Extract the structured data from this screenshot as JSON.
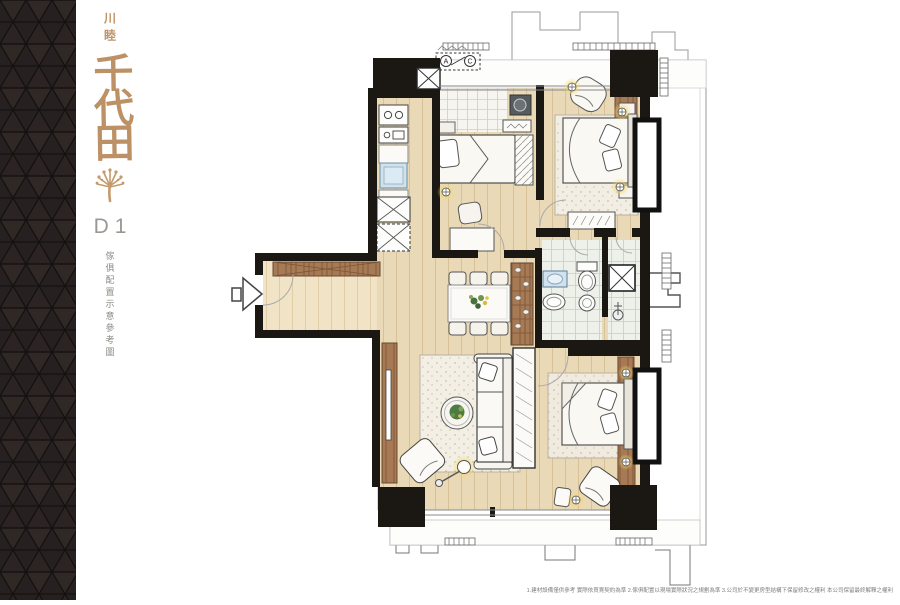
{
  "brand": {
    "developer_logo": "川睦",
    "project_name": "千代田",
    "unit_label": "D1",
    "caption": "傢俱配置示意參考圖",
    "accent_color": "#bf9467",
    "label_color": "#9b9894",
    "tree_icon": "gold-tree-logo"
  },
  "floor_plan": {
    "ac_units": [
      "A",
      "C"
    ],
    "wall_color": "#1b1713",
    "wood_floor_color": "#ead9b6",
    "entry_floor_color": "#f0e2c4",
    "furniture_wood_color": "#a67a54",
    "tile_color": "#f7f5ef",
    "bath_tile_color": "#eef0ea",
    "light_glow_color": "#f3d865",
    "entry_arrow": "entry-direction-arrow"
  },
  "footer": {
    "disclaimer": "1.建材設備僅供參考 實際依買賣契約為準 2.傢俱配置以現場實際狀況之規劃為準 3.公司於不變更房型結構下保留修改之權利 本公司保留最終解釋之權利"
  }
}
